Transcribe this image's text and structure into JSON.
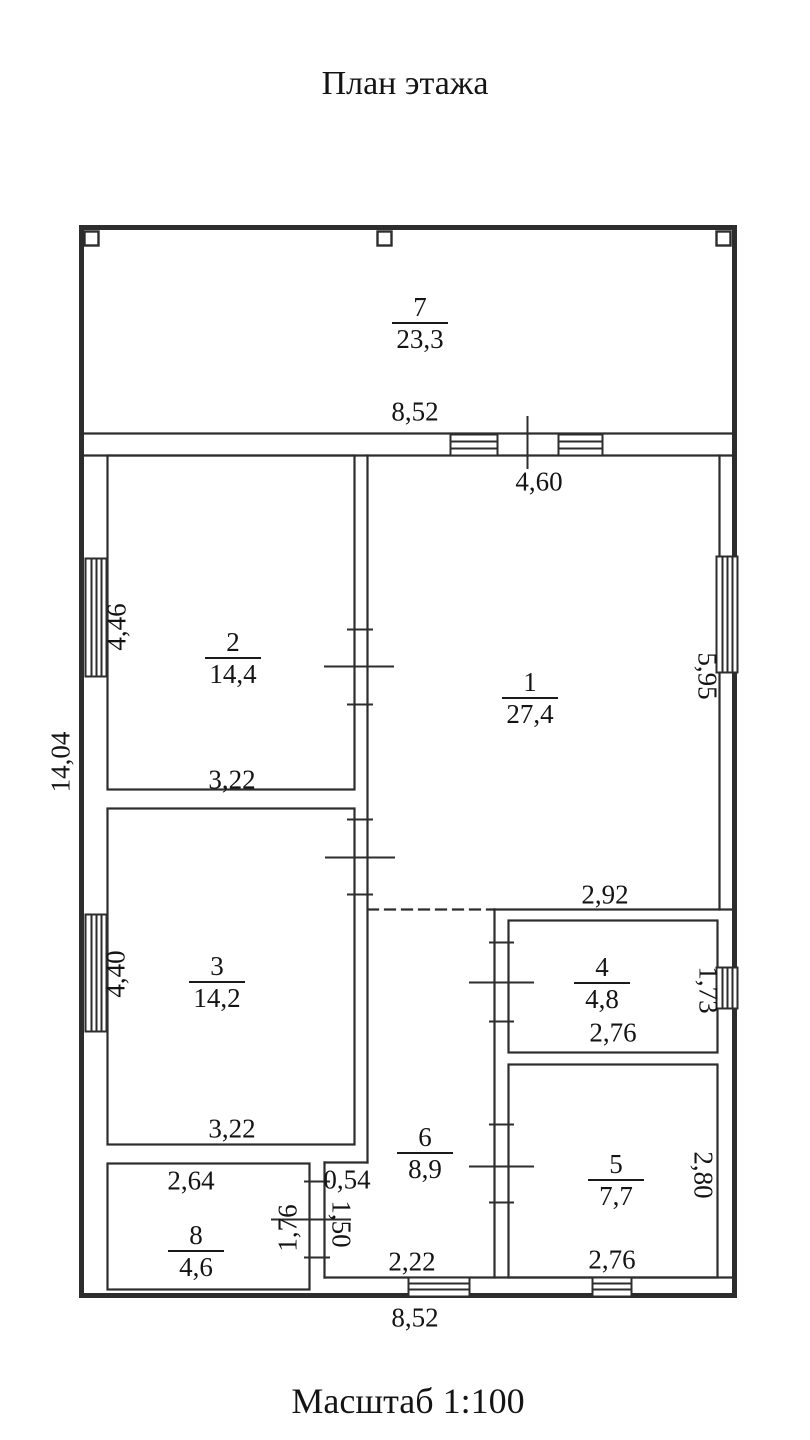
{
  "title": "План этажа",
  "scale": "Масштаб 1:100",
  "rooms": {
    "r1": {
      "num": "1",
      "area": "27,4"
    },
    "r2": {
      "num": "2",
      "area": "14,4"
    },
    "r3": {
      "num": "3",
      "area": "14,2"
    },
    "r4": {
      "num": "4",
      "area": "4,8"
    },
    "r5": {
      "num": "5",
      "area": "7,7"
    },
    "r6": {
      "num": "6",
      "area": "8,9"
    },
    "r7": {
      "num": "7",
      "area": "23,3"
    },
    "r8": {
      "num": "8",
      "area": "4,6"
    }
  },
  "dims": {
    "top_852": "8,52",
    "bottom_852": "8,52",
    "d460": "4,60",
    "d292": "2,92",
    "r2_322": "3,22",
    "r3_322": "3,22",
    "r4_276": "2,76",
    "r5_276": "2,76",
    "d264": "2,64",
    "d054": "0,54",
    "d222": "2,22",
    "d446": "4,46",
    "d1404": "14,04",
    "d440": "4,40",
    "d176": "1,76",
    "d150": "1,50",
    "d595": "5,95",
    "d173": "1,73",
    "d280": "2,80"
  },
  "colors": {
    "line": "#2d2d2d",
    "text": "#141414",
    "background": "#ffffff"
  }
}
